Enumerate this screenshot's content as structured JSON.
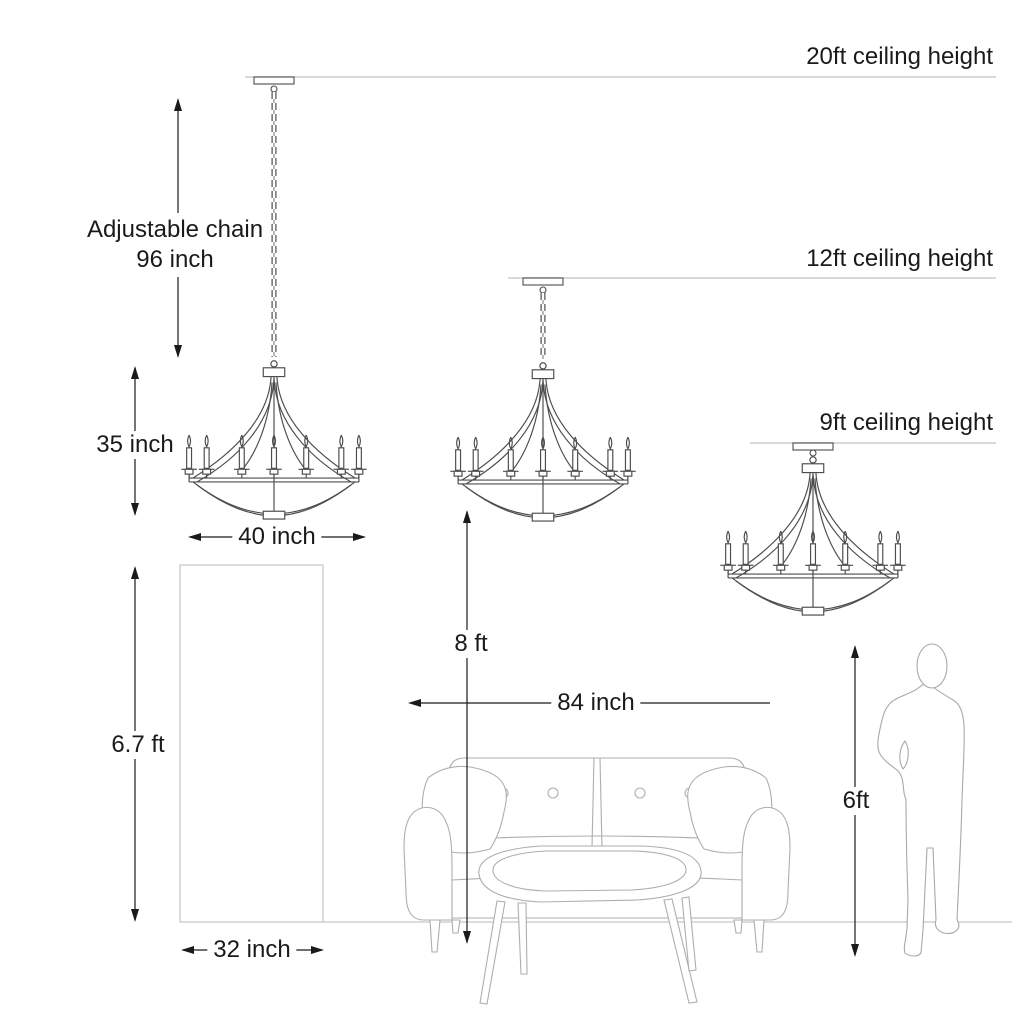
{
  "ceilings": {
    "c20": {
      "label": "20ft ceiling height"
    },
    "c12": {
      "label": "12ft ceiling height"
    },
    "c9": {
      "label": "9ft ceiling height"
    }
  },
  "dimensions": {
    "chain_title": "Adjustable chain",
    "chain_value": "96 inch",
    "chandelier_height": "35 inch",
    "chandelier_width": "40 inch",
    "door_height": "6.7 ft",
    "door_width": "32 inch",
    "hanging_clearance": "8 ft",
    "sofa_width": "84 inch",
    "person_height": "6ft"
  },
  "colors": {
    "dimension_line": "#1a1a1a",
    "chandelier_outline": "#4d4d4d",
    "furniture_outline": "#aeaeae",
    "ceiling_line": "#cbcbcb"
  }
}
